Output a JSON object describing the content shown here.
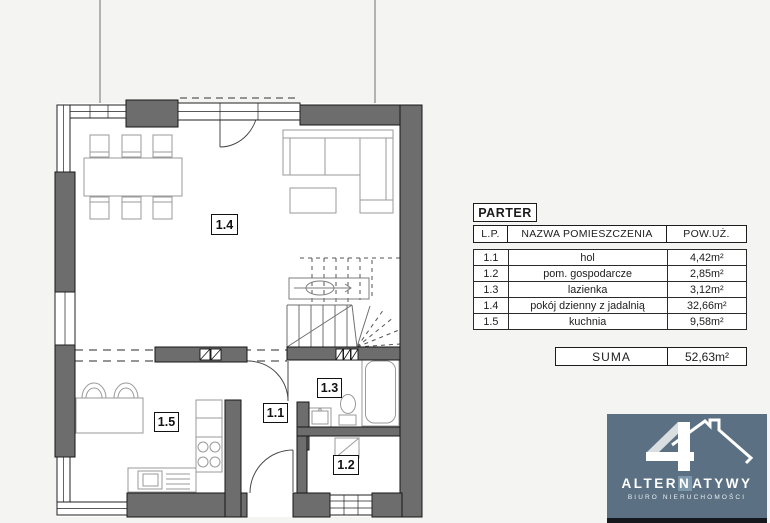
{
  "plan": {
    "rooms": [
      {
        "id": "1.1"
      },
      {
        "id": "1.2"
      },
      {
        "id": "1.3"
      },
      {
        "id": "1.4"
      },
      {
        "id": "1.5"
      }
    ]
  },
  "legend": {
    "title": "PARTER",
    "columns": {
      "lp": "L.P.",
      "name": "NAZWA POMIESZCZENIA",
      "area": "POW.UŻ."
    },
    "rows": [
      {
        "lp": "1.1",
        "name": "hol",
        "area": "4,42m²"
      },
      {
        "lp": "1.2",
        "name": "pom. gospodarcze",
        "area": "2,85m²"
      },
      {
        "lp": "1.3",
        "name": "lazienka",
        "area": "3,12m²"
      },
      {
        "lp": "1.4",
        "name": "pokój dzienny z jadalnią",
        "area": "32,66m²"
      },
      {
        "lp": "1.5",
        "name": "kuchnia",
        "area": "9,58m²"
      }
    ],
    "sum_label": "SUMA",
    "sum_value": "52,63m²"
  },
  "logo": {
    "brand_pre": "ALTER",
    "brand_mid": "N",
    "brand_post": "ATYWY",
    "subtitle": "BIURO NIERUCHOMOŚCI",
    "colors": {
      "background": "#5b7183",
      "accent": "#7d98ab"
    }
  },
  "colors": {
    "wall": "#6d6d6d",
    "floor": "#ffffff",
    "page": "#f4f4f3"
  }
}
